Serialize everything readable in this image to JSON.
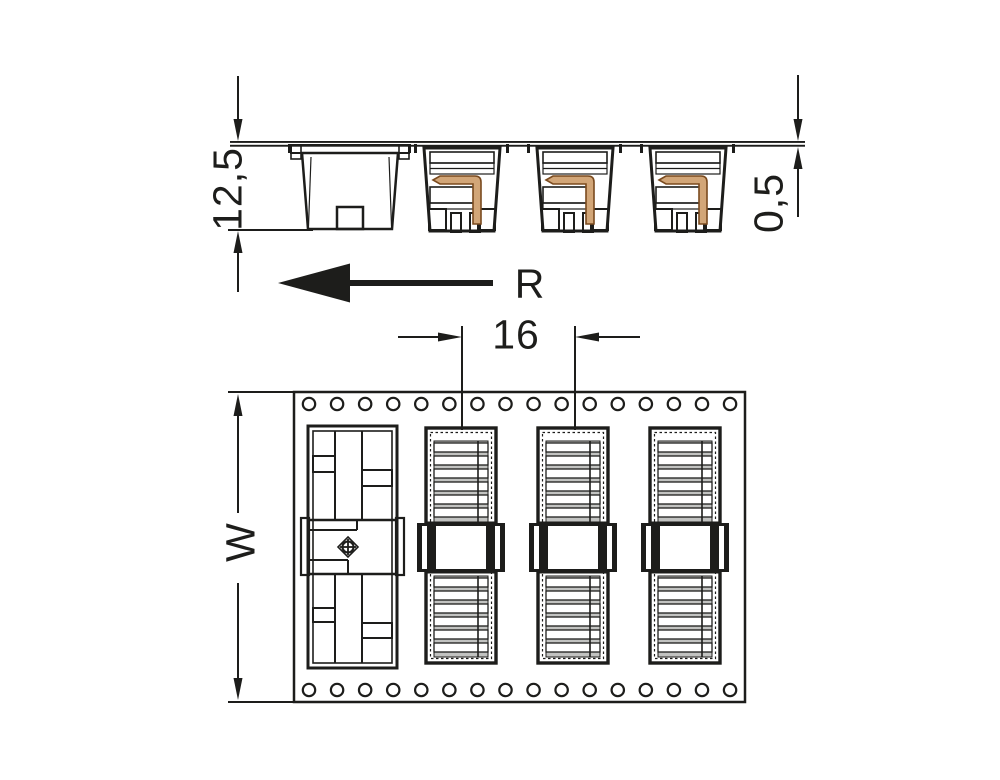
{
  "drawing": {
    "kind": "technical-dimension-drawing",
    "labels": {
      "component_height": "12,5",
      "tape_thickness": "0,5",
      "unreeling_direction": "R",
      "pocket_pitch": "16",
      "tape_width": "W"
    },
    "colors": {
      "background": "#ffffff",
      "line": "#1d1d1b",
      "tape_fill": "#c6c7c5",
      "cap_fill": "#c9cac8",
      "foot_fill": "#c4c5c3",
      "pin_fill": "#d2a678",
      "pin_stroke": "#7a4a1e"
    },
    "side_view": {
      "connector_count": 3,
      "cover_cap_count": 1
    },
    "top_view": {
      "connector_count": 3,
      "cover_cap_count": 1,
      "sprocket_holes_per_row": 16,
      "sprocket_hole_rows": 2
    }
  }
}
